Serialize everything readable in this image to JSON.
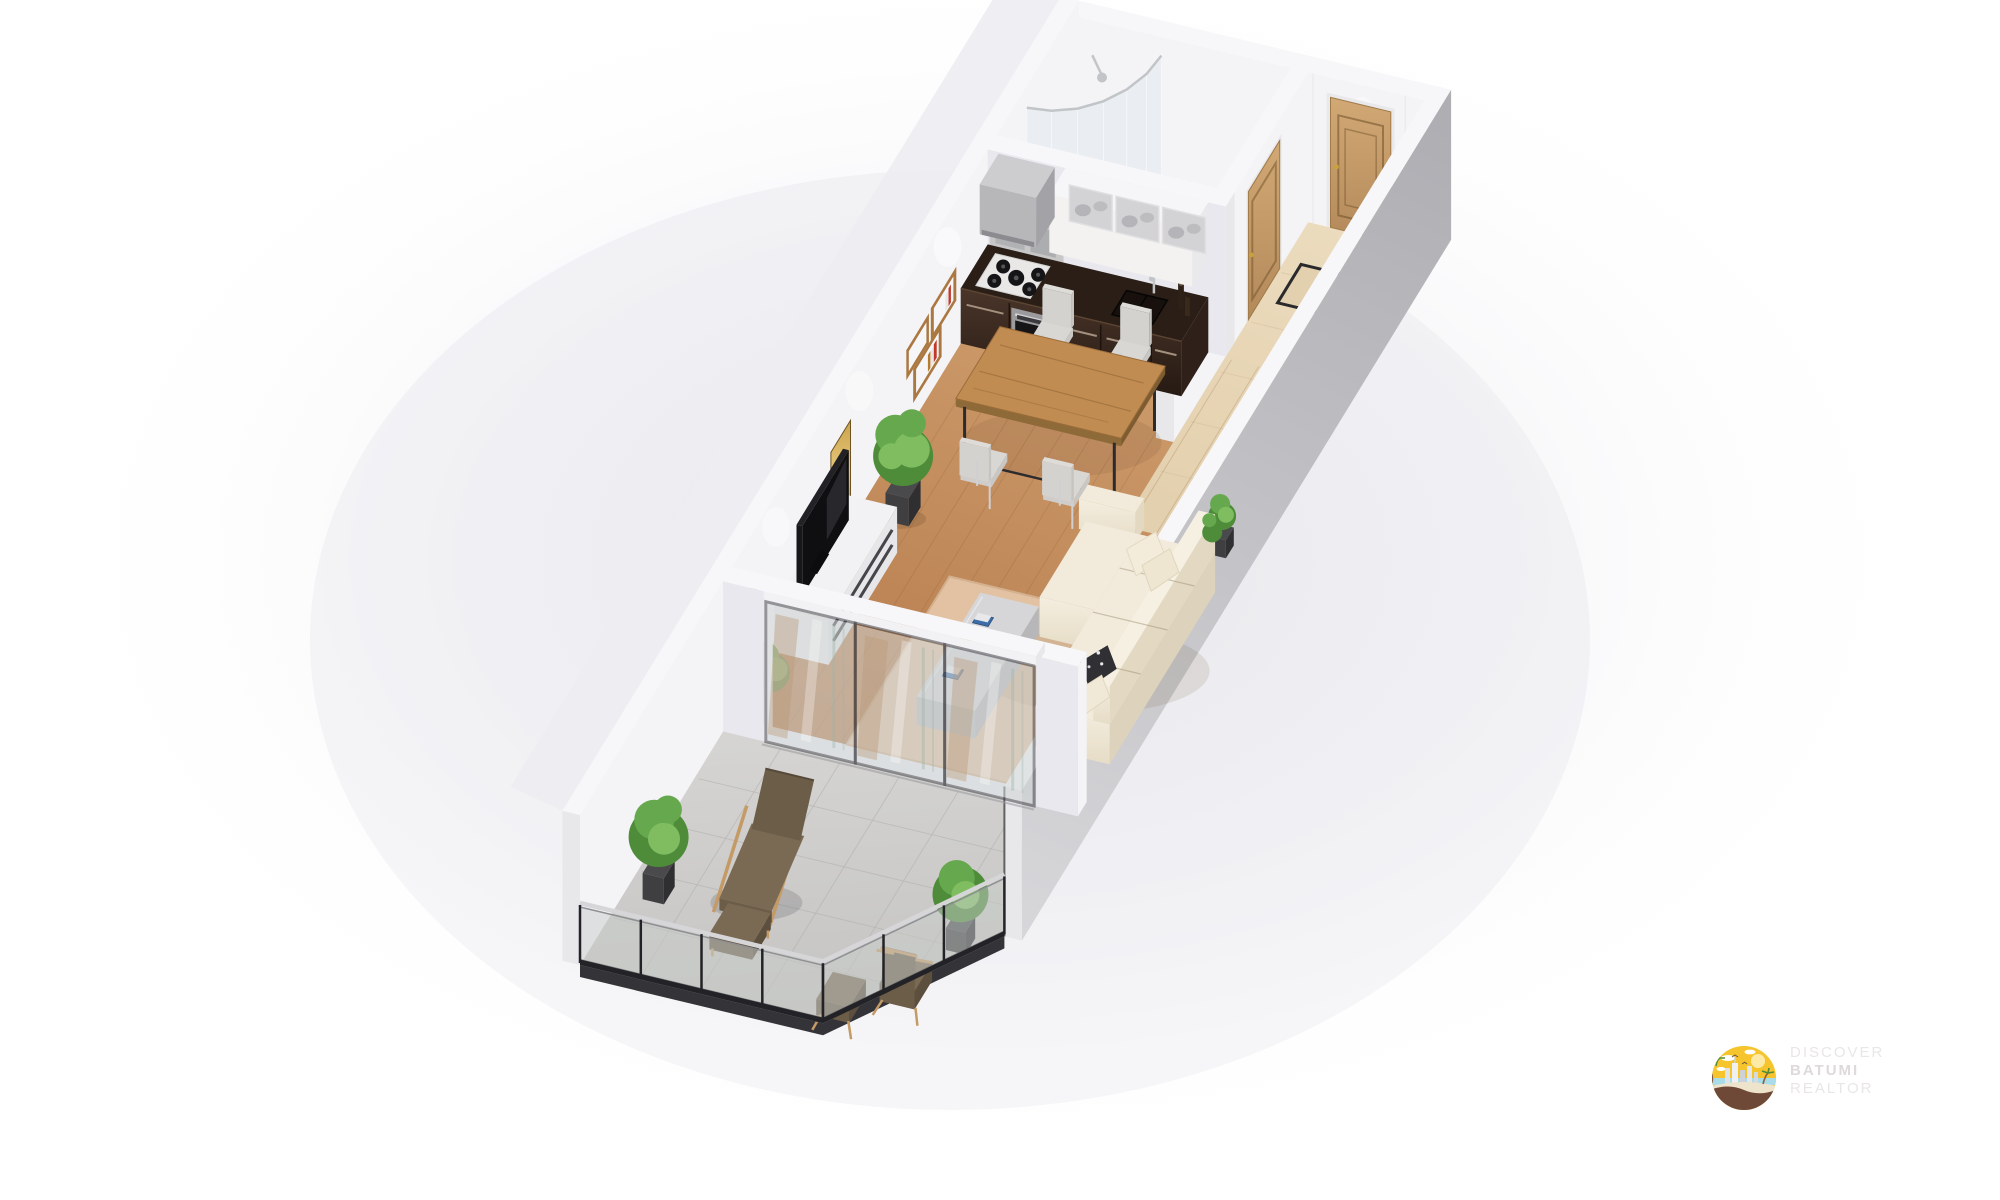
{
  "watermark": {
    "logo_icon": "batumi-seaside-city-logo",
    "line1": "DISCOVER",
    "line2": "BATUMI",
    "line3": "REALTOR"
  },
  "scene": {
    "type": "isometric-3d-floor-plan",
    "rooms": [
      "bathroom",
      "entrance-hallway",
      "kitchen",
      "dining-area",
      "living-room",
      "balcony-terrace"
    ],
    "furniture": [
      "curved-glass-shower",
      "black-toilet",
      "entrance-door",
      "bathroom-door",
      "door-mat",
      "kitchen-counter-with-cooktop-oven-sink",
      "upper-cabinets",
      "range-hood",
      "wall-book-shelf",
      "dining-table",
      "four-dining-chairs",
      "gold-wall-art-panels",
      "tv-stand-with-tv",
      "potted-ficus",
      "cream-corner-sofa",
      "coffee-table",
      "area-rug",
      "sliding-glass-doors",
      "lounge-chair-with-ottoman",
      "balcony-armchair",
      "balcony-stool",
      "two-potted-shrubs",
      "glass-railing"
    ]
  },
  "colors": {
    "wall_top": "#f7f7f9",
    "wall_inner": "#f4f3f6",
    "wall_inner_shade": "#e9e8ee",
    "wall_outer_dark": "#aeaeb3",
    "wall_outer_light": "#d8d8db",
    "wall_end": "#e8e8eb",
    "wood_light": "#cf9e6e",
    "wood_dark": "#b5794a",
    "tile_light": "#efe0c4",
    "tile_dark": "#e3d0ae",
    "bath_floor": "#eaebec",
    "balcony_light": "#d6d5d3",
    "balcony_dark": "#c2c1bf",
    "rug": "#e2c2a2",
    "countertop": "#2a1e16",
    "cabinet_hi": "#4a352a",
    "cabinet_lo": "#261a12",
    "cabinet_handle": "#a3907e",
    "steel": "#9b9b9d",
    "appliance_black": "#151517",
    "cooktop_white": "#e9e8e7",
    "upper_white": "#f3f2f0",
    "frosted_glass": "#d3d3d6",
    "hood_gray": "#b7b7ba",
    "door_wood_hi": "#d2a975",
    "door_wood_lo": "#b3895a",
    "door_handle_gold": "#c9a23e",
    "table_wood_hi": "#c08c52",
    "table_wood_lo": "#a87a42",
    "table_frame": "#2c2c2e",
    "chair_fabric": "#d9d7d4",
    "chair_leg": "#d0d0d3",
    "sofa_hi": "#f2ebdc",
    "sofa_lo": "#e3d9c3",
    "pillow_dark": "#303034",
    "coffee_hi": "#d6d6d8",
    "coffee_lo": "#bfbfc2",
    "tv_black": "#17171a",
    "tv_stand": "#ececee",
    "stand_slot": "#46464a",
    "art_gold_hi": "#e7c878",
    "art_gold_lo": "#8f6f2c",
    "plant_dark": "#4e8c3a",
    "plant_mid": "#66a84e",
    "plant_light": "#7fbd60",
    "pot_dark": "#3f3f41",
    "shower_glass": "#dce8ec",
    "chrome": "#c2c5c7",
    "toilet_black": "#1b1b1d",
    "glass_door": "#cfd4d4",
    "frame_dark": "#46464b",
    "reflection_brown": "#b99877",
    "curtain_green": "#9fb3a8",
    "railing_glass": "#c9cdcb",
    "railing_dark": "#232327",
    "railing_cap": "#d6d6d9",
    "balcony_wood": "#c49a66",
    "balcony_cushion": "#6c5d48",
    "balcony_cushion_hi": "#7a6a54",
    "logo_yellow": "#f6c52e",
    "logo_ground": "#6f4937",
    "logo_sand": "#eee3cb",
    "logo_sea": "#a8dce8",
    "watermark_text": "#e9e6e6",
    "watermark_text_bold": "#dedada"
  }
}
